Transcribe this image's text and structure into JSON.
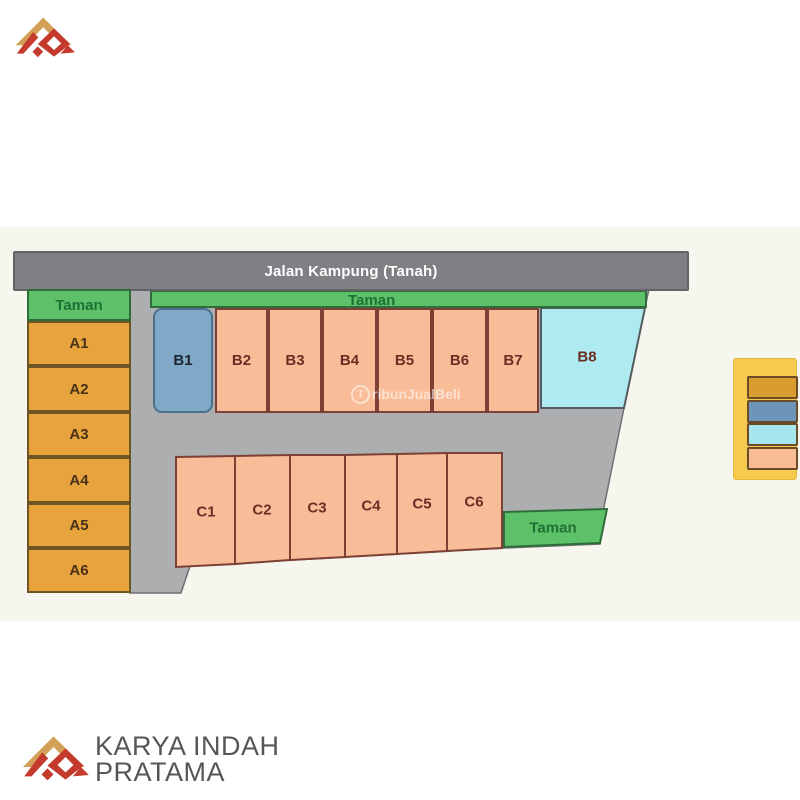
{
  "page": {
    "background": "#ffffff",
    "band_color": "#f6f6ef"
  },
  "colors": {
    "road_bar": "#808084",
    "road_area": "#acaeb0",
    "road_area_border": "#6e6f73",
    "taman_green": "#5cc168",
    "plot_gold": "#e7a43d",
    "plot_peach": "#f8bd98",
    "plot_blue": "#80a8c7",
    "plot_cyan": "#aeeaf0",
    "plot_border": "#7c4034",
    "legend_panel": "#f6c94f"
  },
  "road": {
    "label": "Jalan Kampung (Tanah)"
  },
  "plan": {
    "taman_top_left": "Taman",
    "taman_b_row": "Taman",
    "taman_c_row": "Taman",
    "a_plots": [
      "A1",
      "A2",
      "A3",
      "A4",
      "A5",
      "A6"
    ],
    "b_plots": [
      "B1",
      "B2",
      "B3",
      "B4",
      "B5",
      "B6",
      "B7",
      "B8"
    ],
    "c_plots": [
      "C1",
      "C2",
      "C3",
      "C4",
      "C5",
      "C6"
    ]
  },
  "legend": {
    "swatches": [
      {
        "name": "swatch-gold",
        "color": "#d89c31"
      },
      {
        "name": "swatch-blue",
        "color": "#6d95ba"
      },
      {
        "name": "swatch-cyan",
        "color": "#a6e7ed"
      },
      {
        "name": "swatch-peach",
        "color": "#f9bd96"
      }
    ]
  },
  "watermark": {
    "text": "TribunJualBeli",
    "initial": "T",
    "rest": "ribunJualBeli"
  },
  "branding": {
    "line1": "KARYA INDAH",
    "line2": "PRATAMA"
  }
}
